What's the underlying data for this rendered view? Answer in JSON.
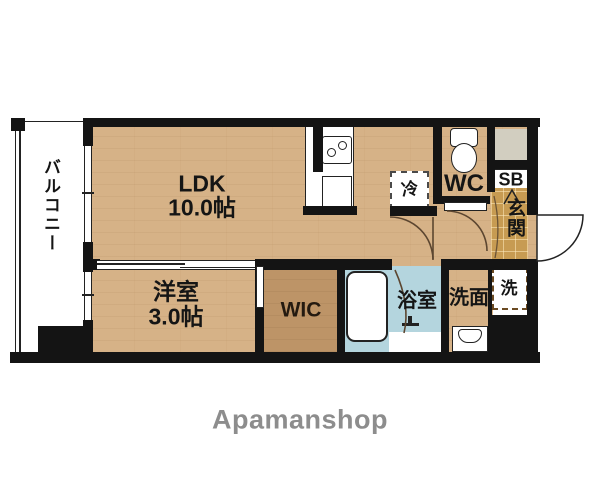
{
  "floorplan": {
    "balcony": {
      "label": "バルコニー"
    },
    "ldk": {
      "name": "LDK",
      "size": "10.0帖"
    },
    "western_room": {
      "name": "洋室",
      "size": "3.0帖"
    },
    "wic": {
      "label": "WIC"
    },
    "wc": {
      "label": "WC"
    },
    "shoe_box": {
      "label": "SB"
    },
    "genkan": {
      "label": "玄関"
    },
    "bathroom": {
      "label": "浴室"
    },
    "washroom": {
      "label": "洗面"
    },
    "washer": {
      "label": "洗"
    },
    "fridge": {
      "label": "冷"
    }
  },
  "branding": {
    "logo_text": "Apamanshop"
  },
  "colors": {
    "wall": "#141414",
    "floor_wood": "#d6b287",
    "wic_floor": "#bd9467",
    "bath_floor": "#b4d5de",
    "genkan_tile": "#c79b52",
    "meter_box_gray": "#d2cec0",
    "logo_gray": "#8d8d8d"
  }
}
